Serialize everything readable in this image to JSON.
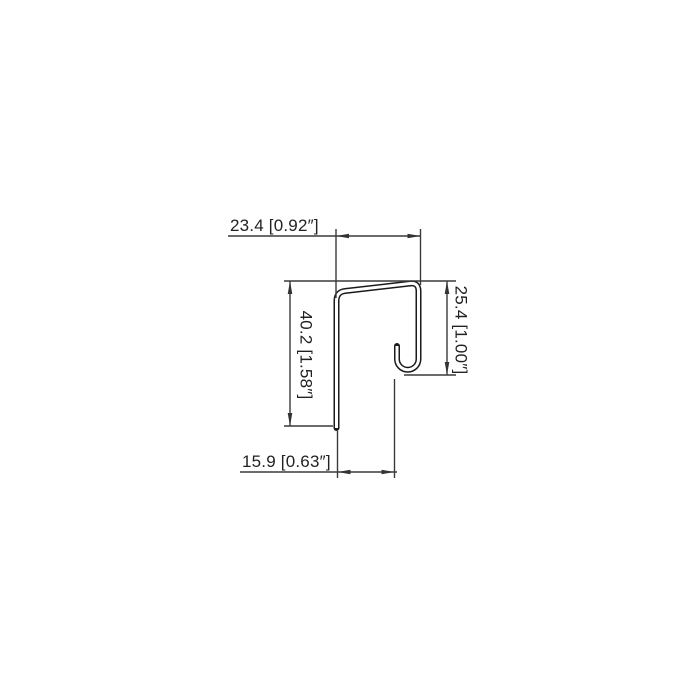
{
  "page": {
    "background": "#ffffff",
    "line_color": "#3a3a3a",
    "profile_color": "#1a1a1a"
  },
  "drawing": {
    "kind": "sheet-metal j-channel trim profile cross-section",
    "dimensions": {
      "top_width": {
        "label": "23.4 [0.92″]",
        "mm": "23.4",
        "inch": "0.92″"
      },
      "left_height": {
        "label": "40.2 [1.58″]",
        "mm": "40.2",
        "inch": "1.58″"
      },
      "right_height": {
        "label": "25.4 [1.00″]",
        "mm": "25.4",
        "inch": "1.00″"
      },
      "bottom_width": {
        "label": "15.9 [0.63″]",
        "mm": "15.9",
        "inch": "0.63″"
      }
    }
  }
}
